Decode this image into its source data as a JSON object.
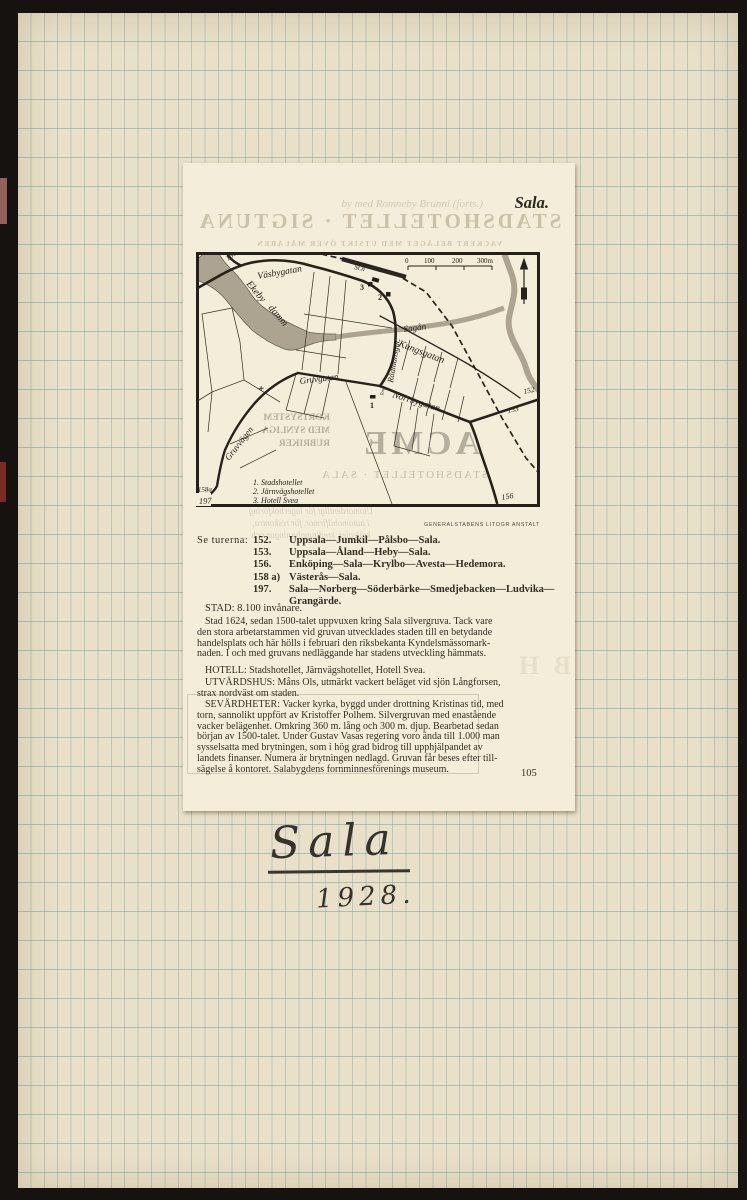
{
  "page": {
    "title": "Sala.",
    "page_number": "105",
    "credit": "GENERALSTABENS LITOGR ANSTALT"
  },
  "bleed": {
    "forts_line": "by med Romneby Brunni (forts.)",
    "line1": "STADSHOTELLET · SIGTUNA",
    "line2": "VACKERT BELÄGET MED UTSIKT ÖVER MÄLAREN",
    "acme": "ACME",
    "kort1": "KORTSYSTEM",
    "kort2": "MED SYNLIGA",
    "kort3": "RUBRIKER",
    "stads_sala": "STADSHOTELLET · SALA",
    "under1": "Utomordentligt för lagerbokföring",
    "under2": "i automobilfirmor, för reskontra,",
    "under3": "kollegier, kreditupplysningar och",
    "side_letters": "B H"
  },
  "map": {
    "scale": {
      "t0": "0",
      "t100": "100",
      "t200": "200",
      "t300": "300m"
    },
    "labels": {
      "road156_top": "156",
      "vasbygatan": "Väsbygatan",
      "station": "St.n",
      "ekeby": "Ekeby",
      "damm": "damm",
      "sagan": "Sagån",
      "radmansgat": "Rådmansgat.",
      "kungsgatan": "Kungsgatan",
      "gruvgatan": "Gruvgatan",
      "torg": "Torg",
      "norrbygatan": "Norrbygatan",
      "gruvvagen": "Gruvvägen",
      "n152": "152",
      "n153": "153",
      "n156_bottom": "156",
      "n158a": "158a",
      "n197": "197",
      "m1": "1",
      "m2": "2",
      "m3": "3",
      "church": "+"
    },
    "legend": {
      "l1": "1.  Stadshotellet",
      "l2": "2.  Järnvägshotellet",
      "l3": "3.  Hotell Svea"
    }
  },
  "routes": {
    "heading": "Se turerna:",
    "items": [
      {
        "num": "152.",
        "text": "Uppsala—Jumkil—Pålsbo—Sala."
      },
      {
        "num": "153.",
        "text": "Uppsala—Åland—Heby—Sala."
      },
      {
        "num": "156.",
        "text": "Enköping—Sala—Krylbo—Avesta—Hedemora."
      },
      {
        "num": "158 a)",
        "text": "Västerås—Sala."
      },
      {
        "num": "197.",
        "text": "Sala—Norberg—Söderbärke—Smedjebacken—Ludvika—"
      }
    ],
    "continuation": "Grangärde."
  },
  "body": {
    "stad": "STAD: 8.100 invånare.",
    "para1": [
      "Stad 1624, sedan 1500-talet uppvuxen kring Sala silvergruva.  Tack vare",
      "den stora arbetarstammen vid gruvan utvecklades staden till en betydande",
      "handelsplats och här hölls i februari den riksbekanta Kyndelsmässomark-",
      "naden.  I och med gruvans nedläggande har stadens utveckling hämmats."
    ],
    "hotell": "HOTELL: Stadshotellet, Järnvägshotellet, Hotell Svea.",
    "utvardshus": [
      "UTVÄRDSHUS: Måns Ols, utmärkt vackert beläget vid sjön Långforsen,",
      "strax nordväst om staden."
    ],
    "sevardheter": [
      "SEVÄRDHETER: Vacker kyrka, byggd under drottning Kristinas tid, med",
      "torn, sannolikt uppfört av Kristoffer Polhem.  Silvergruvan med enastående",
      "vacker belägenhet.  Omkring 360 m. lång och 300 m. djup.  Bearbetad sedan",
      "början av 1500-talet.  Under Gustav Vasas regering voro ända till 1.000 man",
      "sysselsatta med brytningen, som i hög grad bidrog till upphjälpandet av",
      "landets finanser.  Numera är brytningen nedlagd.  Gruvan får beses efter till-",
      "sägelse å kontoret.  Salabygdens fornminnesförenings museum."
    ]
  },
  "handwriting": {
    "title": "Sala",
    "year": "1928."
  }
}
